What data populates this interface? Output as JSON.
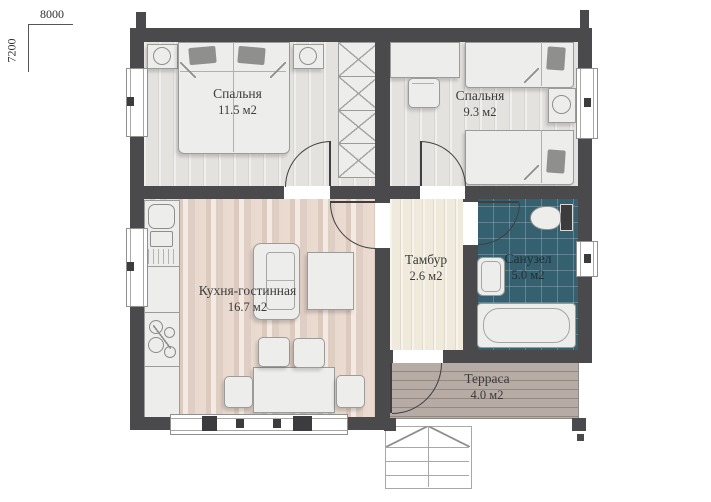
{
  "dimensions": {
    "width_label": "8000",
    "height_label": "7200"
  },
  "rooms": {
    "bedroom1": {
      "name": "Спальня",
      "area": "11.5 м2"
    },
    "bedroom2": {
      "name": "Спальня",
      "area": "9.3 м2"
    },
    "kitchen": {
      "name": "Кухня-гостинная",
      "area": "16.7 м2"
    },
    "vestibule": {
      "name": "Тамбур",
      "area": "2.6 м2"
    },
    "bathroom": {
      "name": "Санузел",
      "area": "5.0 м2"
    },
    "terrace": {
      "name": "Терраса",
      "area": "4.0 м2"
    }
  },
  "colors": {
    "wall": "#4a4a4c",
    "bathroom_tile": "#34606f",
    "kitchen_floor": "#e2d2c8",
    "terrace_floor": "#b2a6a0",
    "vestibule_floor": "#efeadb",
    "label_text": "#3b3b3b"
  }
}
